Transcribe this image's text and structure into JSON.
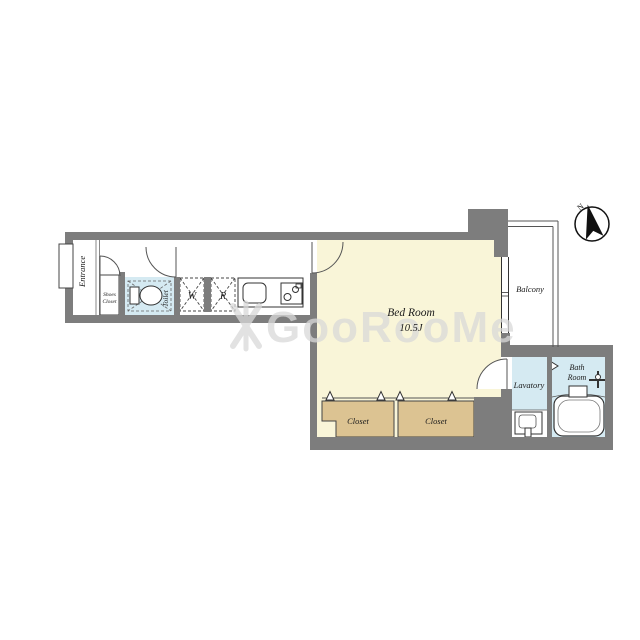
{
  "colors": {
    "wall": "#7d7d7d",
    "wet_room": "#d5eaf2",
    "bedroom": "#f9f5d8",
    "closet": "#dcc392",
    "label": "#1b1b1b",
    "line": "#444444",
    "watermark": "#d9d9d9"
  },
  "rooms": {
    "entrance": {
      "label": "Entrance"
    },
    "shoes_closet": {
      "line1": "Shoes",
      "line2": "Closet"
    },
    "toilet": {
      "label": "Toilet"
    },
    "washer": {
      "label": "W"
    },
    "refrigerator": {
      "label": "R"
    },
    "bedroom": {
      "label": "Bed Room",
      "size": "10.5J"
    },
    "closet_left": {
      "label": "Closet"
    },
    "closet_right": {
      "label": "Closet"
    },
    "balcony": {
      "label": "Balcony"
    },
    "lavatory": {
      "label": "Lavatory"
    },
    "bathroom": {
      "line1": "Bath",
      "line2": "Room"
    }
  },
  "compass": {
    "label": "N"
  },
  "watermark": {
    "text": "GooRooMe"
  }
}
